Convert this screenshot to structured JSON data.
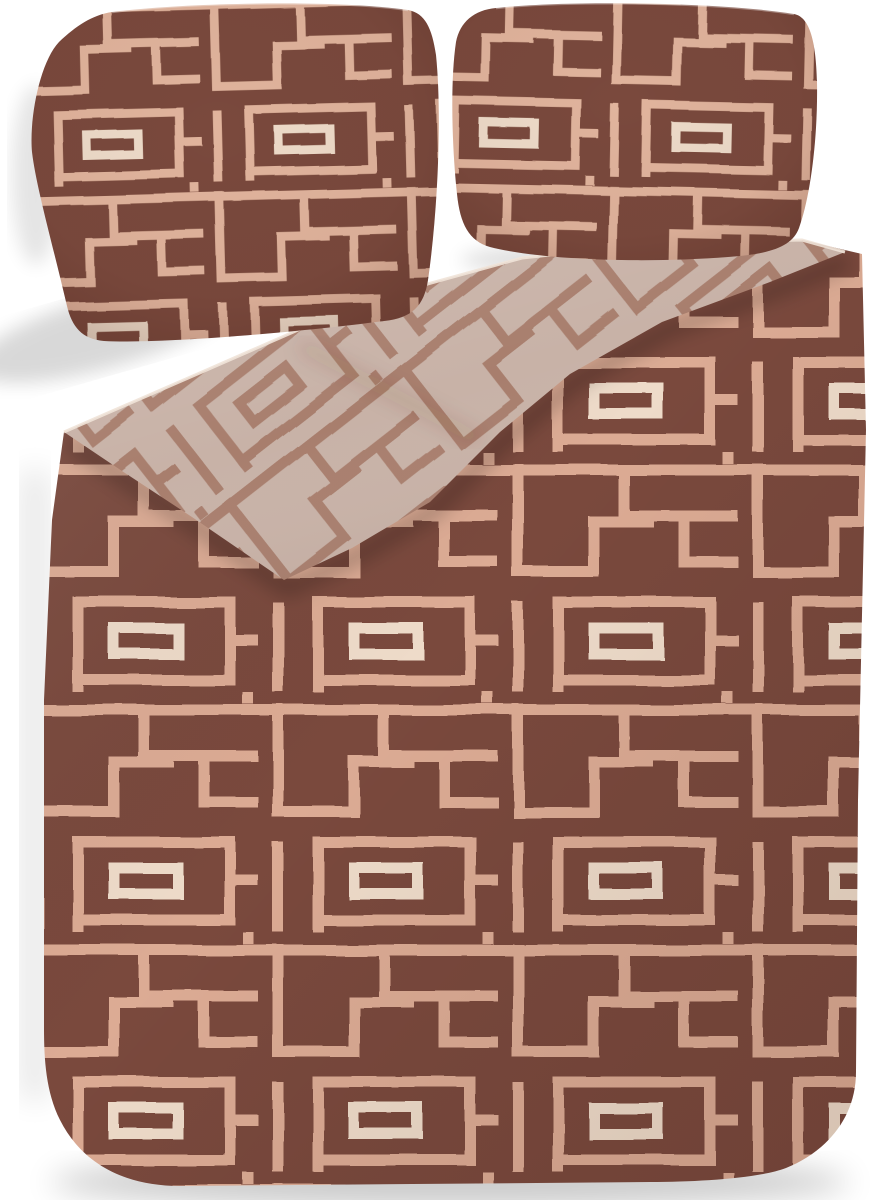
{
  "scene": {
    "type": "product-photograph",
    "description": "Bedding set photographed on a white studio background: two terracotta-brown pillowcases with a rose-gold geometric maze pattern, and a matching duvet cover whose top corner is folded back to reveal the beige reverse side printed with the same maze pattern in copper rose-gold.",
    "items": [
      {
        "name": "pillowcase-left",
        "fabric": "terracotta brown with rose-gold maze lines"
      },
      {
        "name": "pillowcase-right",
        "fabric": "terracotta brown with rose-gold maze lines"
      },
      {
        "name": "duvet-cover",
        "fabric": "terracotta brown with rose-gold maze lines, rounded bottom corners"
      },
      {
        "name": "duvet-fold-reverse",
        "fabric": "beige reverse side with diagonal copper maze lines, folded over the top-left corner"
      }
    ],
    "background": "white with soft drop shadows"
  },
  "colors": {
    "bg": "#ffffff",
    "brown": "#7a4a3c",
    "brownDeep": "#6b4034",
    "rose": "#dcab94",
    "roseLight": "#eedbc9",
    "pillowRose": "#e1b49d",
    "beige": "#c8b2a7",
    "copper": "#a87e6d",
    "edgeHighlight": "#f0e3d8"
  }
}
